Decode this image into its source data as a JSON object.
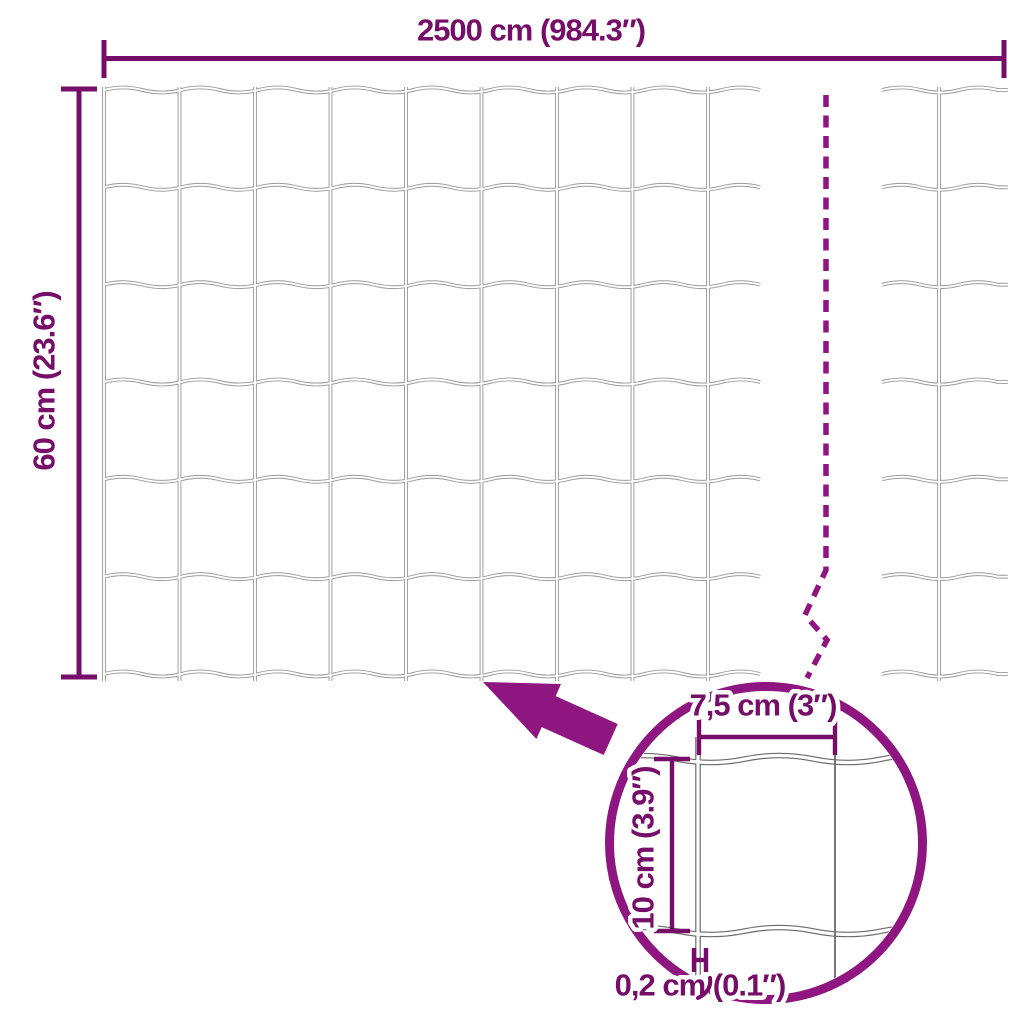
{
  "diagram": {
    "labels": {
      "total_width": "2500 cm (984.3″)",
      "total_height": "60 cm (23.6″)",
      "opening_width": "7,5 cm (3″)",
      "opening_height": "10 cm (3.9″)",
      "wire_thickness": "0,2 cm (0.1″)"
    },
    "icons": {
      "zoom_arrow": "filled-arrow-pointing-up-left",
      "magnifier_circle": "detail-zoom-circle-outline",
      "break_line": "vertical-dashed-zigzag-break"
    },
    "colors": {
      "annotation_text": "#760d68",
      "annotation_accent": "#8f1580",
      "mesh_wire": "#9a9a9a",
      "detail_wire": "#6a6a6a",
      "background": "#ffffff"
    }
  }
}
